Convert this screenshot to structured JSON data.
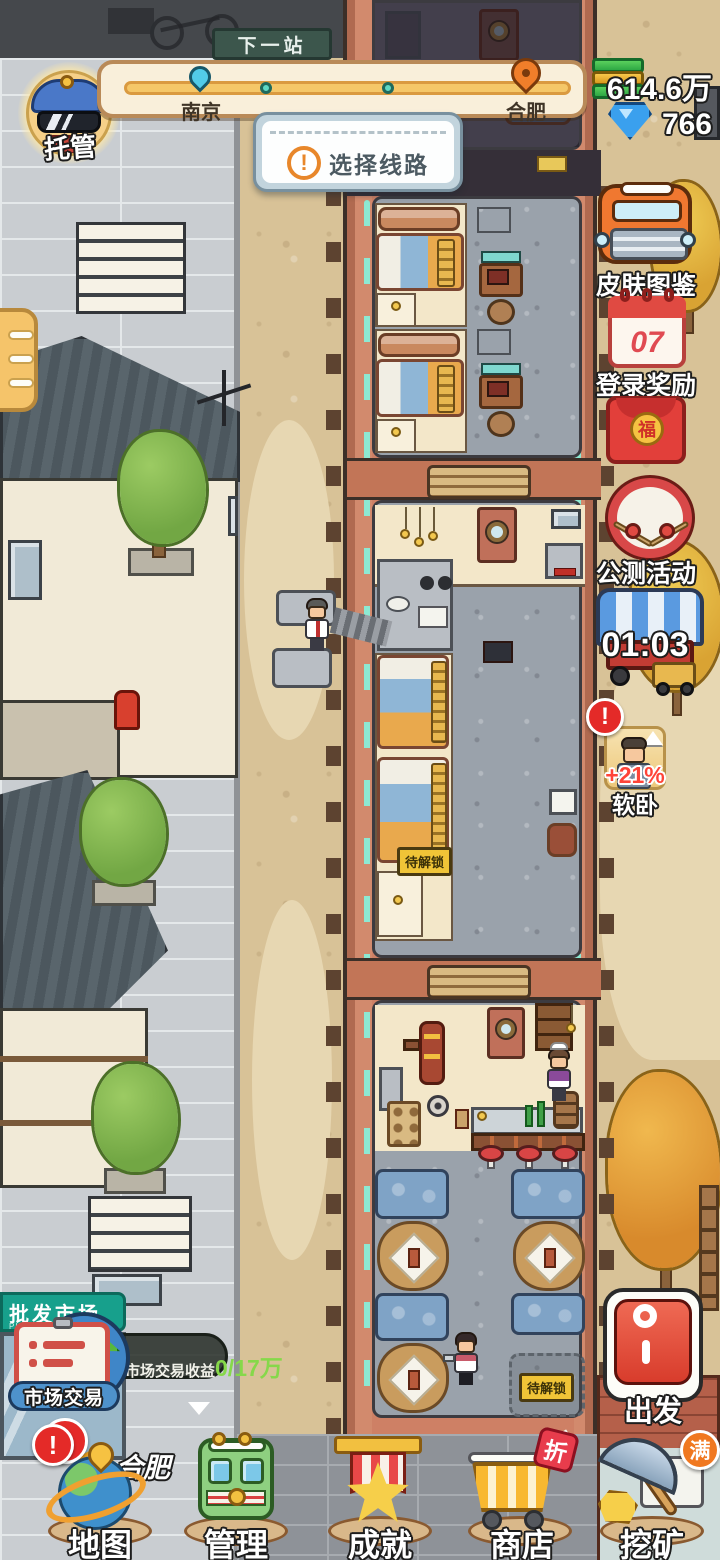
{
  "hud": {
    "avatar_label": "托管",
    "next_station": "下一站",
    "route": {
      "from": "南京",
      "to": "合肥"
    },
    "currency": {
      "money": "614.6万",
      "gems": "766"
    },
    "dialog_icon": "!",
    "dialog_label": "选择线路"
  },
  "sidebar": {
    "skin_label": "皮肤图鉴",
    "login_label": "登录奖励",
    "login_day": "07",
    "envelope_char": "福",
    "beta_label": "公测活动",
    "truck_timer": "01:03",
    "buff_badge": "!",
    "buff_percent": "+21%",
    "buff_label": "软卧"
  },
  "train": {
    "sign_first_class": "头等座",
    "sign_soft_sleeper": "软卧",
    "locked_bed": "待解锁",
    "locked_booth": "待解锁"
  },
  "market": {
    "building_sign": "批发市场",
    "building_sign_sub": "PIFASHICHANG",
    "tooltip_label": "市场交易收益",
    "tooltip_value": "0/17万",
    "button_label": "市场交易",
    "badge": "!",
    "city_label": "合肥"
  },
  "depart": {
    "label": "出发"
  },
  "nav": {
    "items": [
      {
        "label": "地图",
        "badge": "!"
      },
      {
        "label": "管理"
      },
      {
        "label": "成就"
      },
      {
        "label": "商店",
        "tag": "折"
      },
      {
        "label": "挖矿",
        "badge": "满"
      }
    ]
  }
}
